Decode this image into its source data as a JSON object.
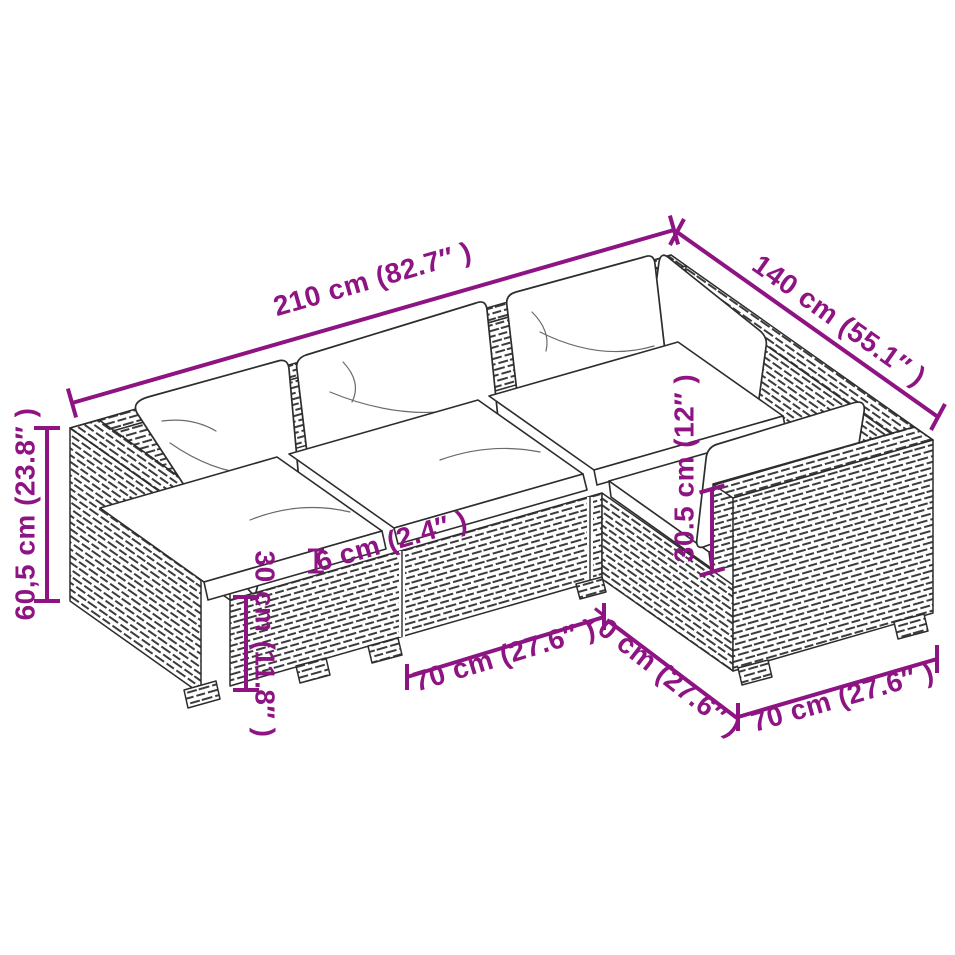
{
  "page": {
    "title": "L-shaped poly rattan sofa set dimension diagram"
  },
  "colors": {
    "dimension_annotation": "#8E1383",
    "line_art": "#2D2D2D",
    "background": "#FFFFFF"
  },
  "dimensions": {
    "total_width": "210 cm (82.7″ )",
    "total_depth": "140 cm (55.1″ )",
    "total_height": "60,5 cm (23.8″ )",
    "base_height": "30 cm (11.8″ )",
    "cushion_thickness": "6 cm (2.4″ )",
    "backrest_above_seat": "30.5 cm (12″ )",
    "module_width_front": "70 cm (27.6″ )",
    "module_depth_right": "70 cm (27.6″ )",
    "module_width_right": "70 cm (27.6″ )"
  }
}
